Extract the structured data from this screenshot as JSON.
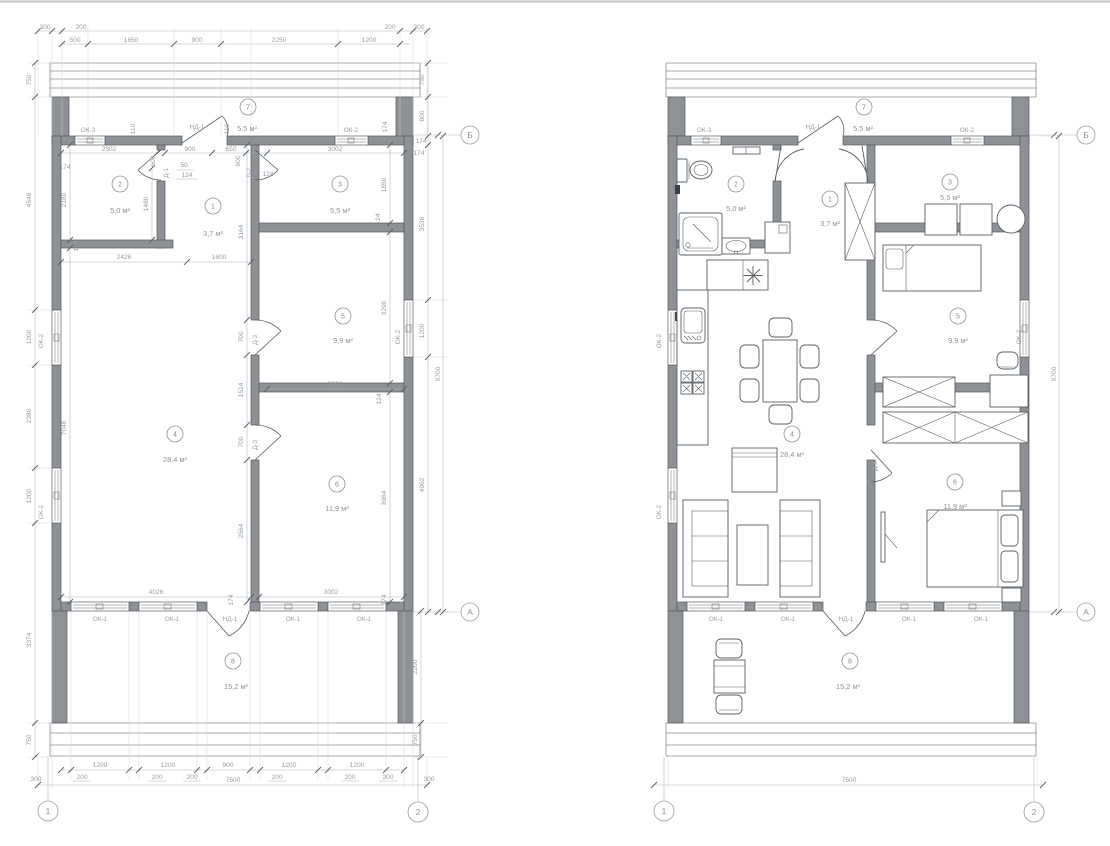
{
  "drawing": {
    "type": "floor-plan",
    "views": [
      "dimensioned plan",
      "furnished plan"
    ]
  },
  "grid": {
    "c1": "1",
    "c2": "2",
    "rowA": "А",
    "rowB": "Б"
  },
  "openings": {
    "ok1": "ОК-1",
    "ok2": "ОК-2",
    "ok3": "ОК-3",
    "nd1": "НД-1",
    "d1": "Д-1",
    "d2": "Д-2",
    "d3": "Д-3"
  },
  "rooms": [
    {
      "num": "1",
      "area": "3,7 м²"
    },
    {
      "num": "2",
      "area": "5,0 м²"
    },
    {
      "num": "3",
      "area": "5,5 м²"
    },
    {
      "num": "4",
      "area": "28,4 м²"
    },
    {
      "num": "5",
      "area": "9,9 м²"
    },
    {
      "num": "6",
      "area": "11,9 м²"
    },
    {
      "num": "7",
      "area": "5,5 м²"
    },
    {
      "num": "8",
      "area": "15,2 м²"
    }
  ],
  "dims": {
    "total_w": "7500",
    "total_h": "9700",
    "top_row1": [
      "300",
      "200",
      "200",
      "300"
    ],
    "top_row2": [
      "500",
      "1650",
      "900",
      "2250",
      "1200"
    ],
    "left_col": [
      "750",
      "4548",
      "1200",
      "2380",
      "1200",
      "3374",
      "750"
    ],
    "right_col": [
      "750",
      "800",
      "174",
      "3538",
      "1200",
      "4962",
      "2200",
      "750"
    ],
    "bottom_sizes": [
      "1200",
      "1200",
      "900",
      "1200",
      "1200"
    ],
    "bottom_gaps": [
      "200",
      "200",
      "200",
      "200",
      "200",
      "200"
    ],
    "bottom_corners": [
      "300",
      "300"
    ],
    "interior": {
      "room2_w": "2302",
      "hall_w": "900",
      "hall_w650": "650",
      "room3_w": "3002",
      "lr_w1": "2426",
      "lr_w2": "1600",
      "room5_w": "3002",
      "room6_w": "3002",
      "lr_w3": "4026",
      "hall_h": "3164",
      "seg700a": "700",
      "seg1524": "1524",
      "seg700b": "700",
      "seg2564": "2564",
      "room2_h": "2180",
      "room2_inner": "1480",
      "lr_h": "7048",
      "room3_h": "1850",
      "room5_h": "3290",
      "room6_h": "3964",
      "door600a": "600",
      "door600b": "600",
      "d50": "50",
      "d124a": "124",
      "d124b": "124",
      "d124c": "124",
      "d124d": "124",
      "d124e": "124",
      "gap110a": "110",
      "gap110b": "110",
      "t174a": "174",
      "t174b": "174",
      "t174c": "174",
      "t174d": "174",
      "t174e": "174"
    }
  }
}
